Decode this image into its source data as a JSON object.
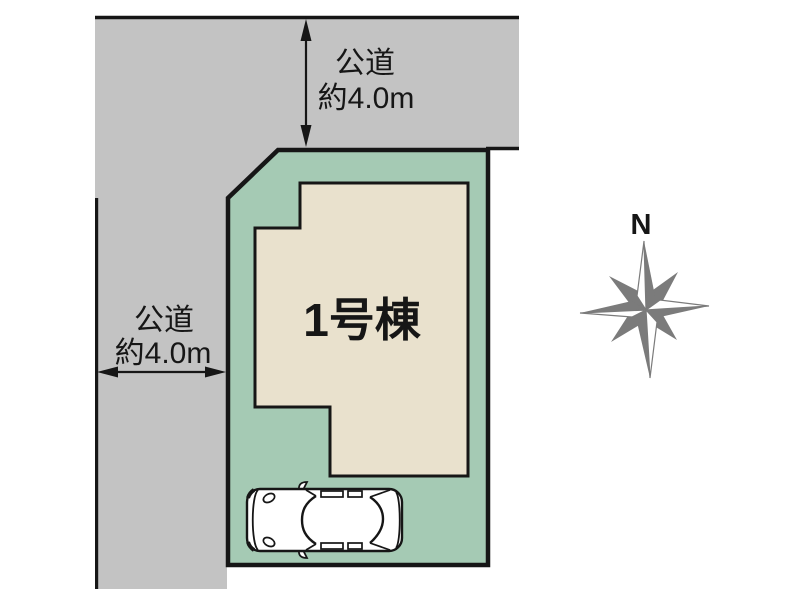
{
  "roads": {
    "top": {
      "label_line1": "公道",
      "label_line2": "約4.0m"
    },
    "left": {
      "label_line1": "公道",
      "label_line2": "約4.0m"
    }
  },
  "plot": {
    "building_label": "1号棟"
  },
  "compass": {
    "north_label": "N"
  },
  "colors": {
    "road_gray": "#c3c3c3",
    "plot_green": "#a5cab4",
    "building_beige": "#e9e1cd",
    "outline_black": "#161616",
    "compass_gray": "#7b7b7b"
  }
}
